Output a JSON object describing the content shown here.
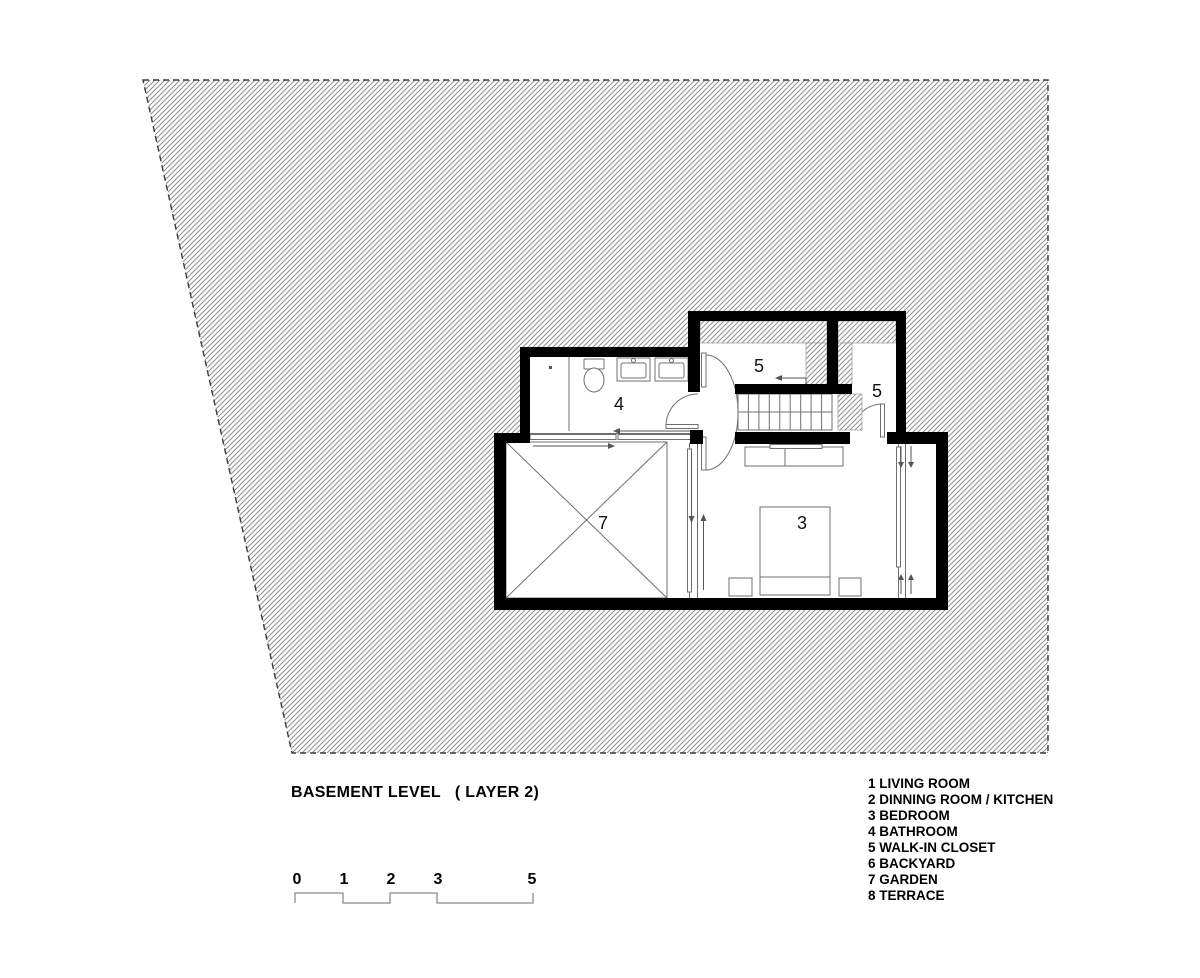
{
  "drawing": {
    "title": "BASEMENT LEVEL   ( LAYER 2)",
    "room_labels": {
      "bathroom": "4",
      "closet_top": "5",
      "closet_right": "5",
      "garden": "7",
      "bedroom": "3"
    },
    "scale_bar": {
      "ticks": [
        "0",
        "1",
        "2",
        "3",
        "5"
      ]
    },
    "legend": {
      "items": [
        "1 LIVING ROOM",
        "2 DINNING ROOM / KITCHEN",
        "3 BEDROOM",
        "4 BATHROOM",
        "5 WALK-IN CLOSET",
        "6 BACKYARD",
        "7 GARDEN",
        "8 TERRACE"
      ]
    },
    "colors": {
      "wall": "#000000",
      "hatch_line": "#8f8f8f",
      "boundary_dash": "#3a3a3a",
      "thin_line": "#6f6f6f",
      "text": "#000000",
      "background": "#ffffff"
    }
  }
}
